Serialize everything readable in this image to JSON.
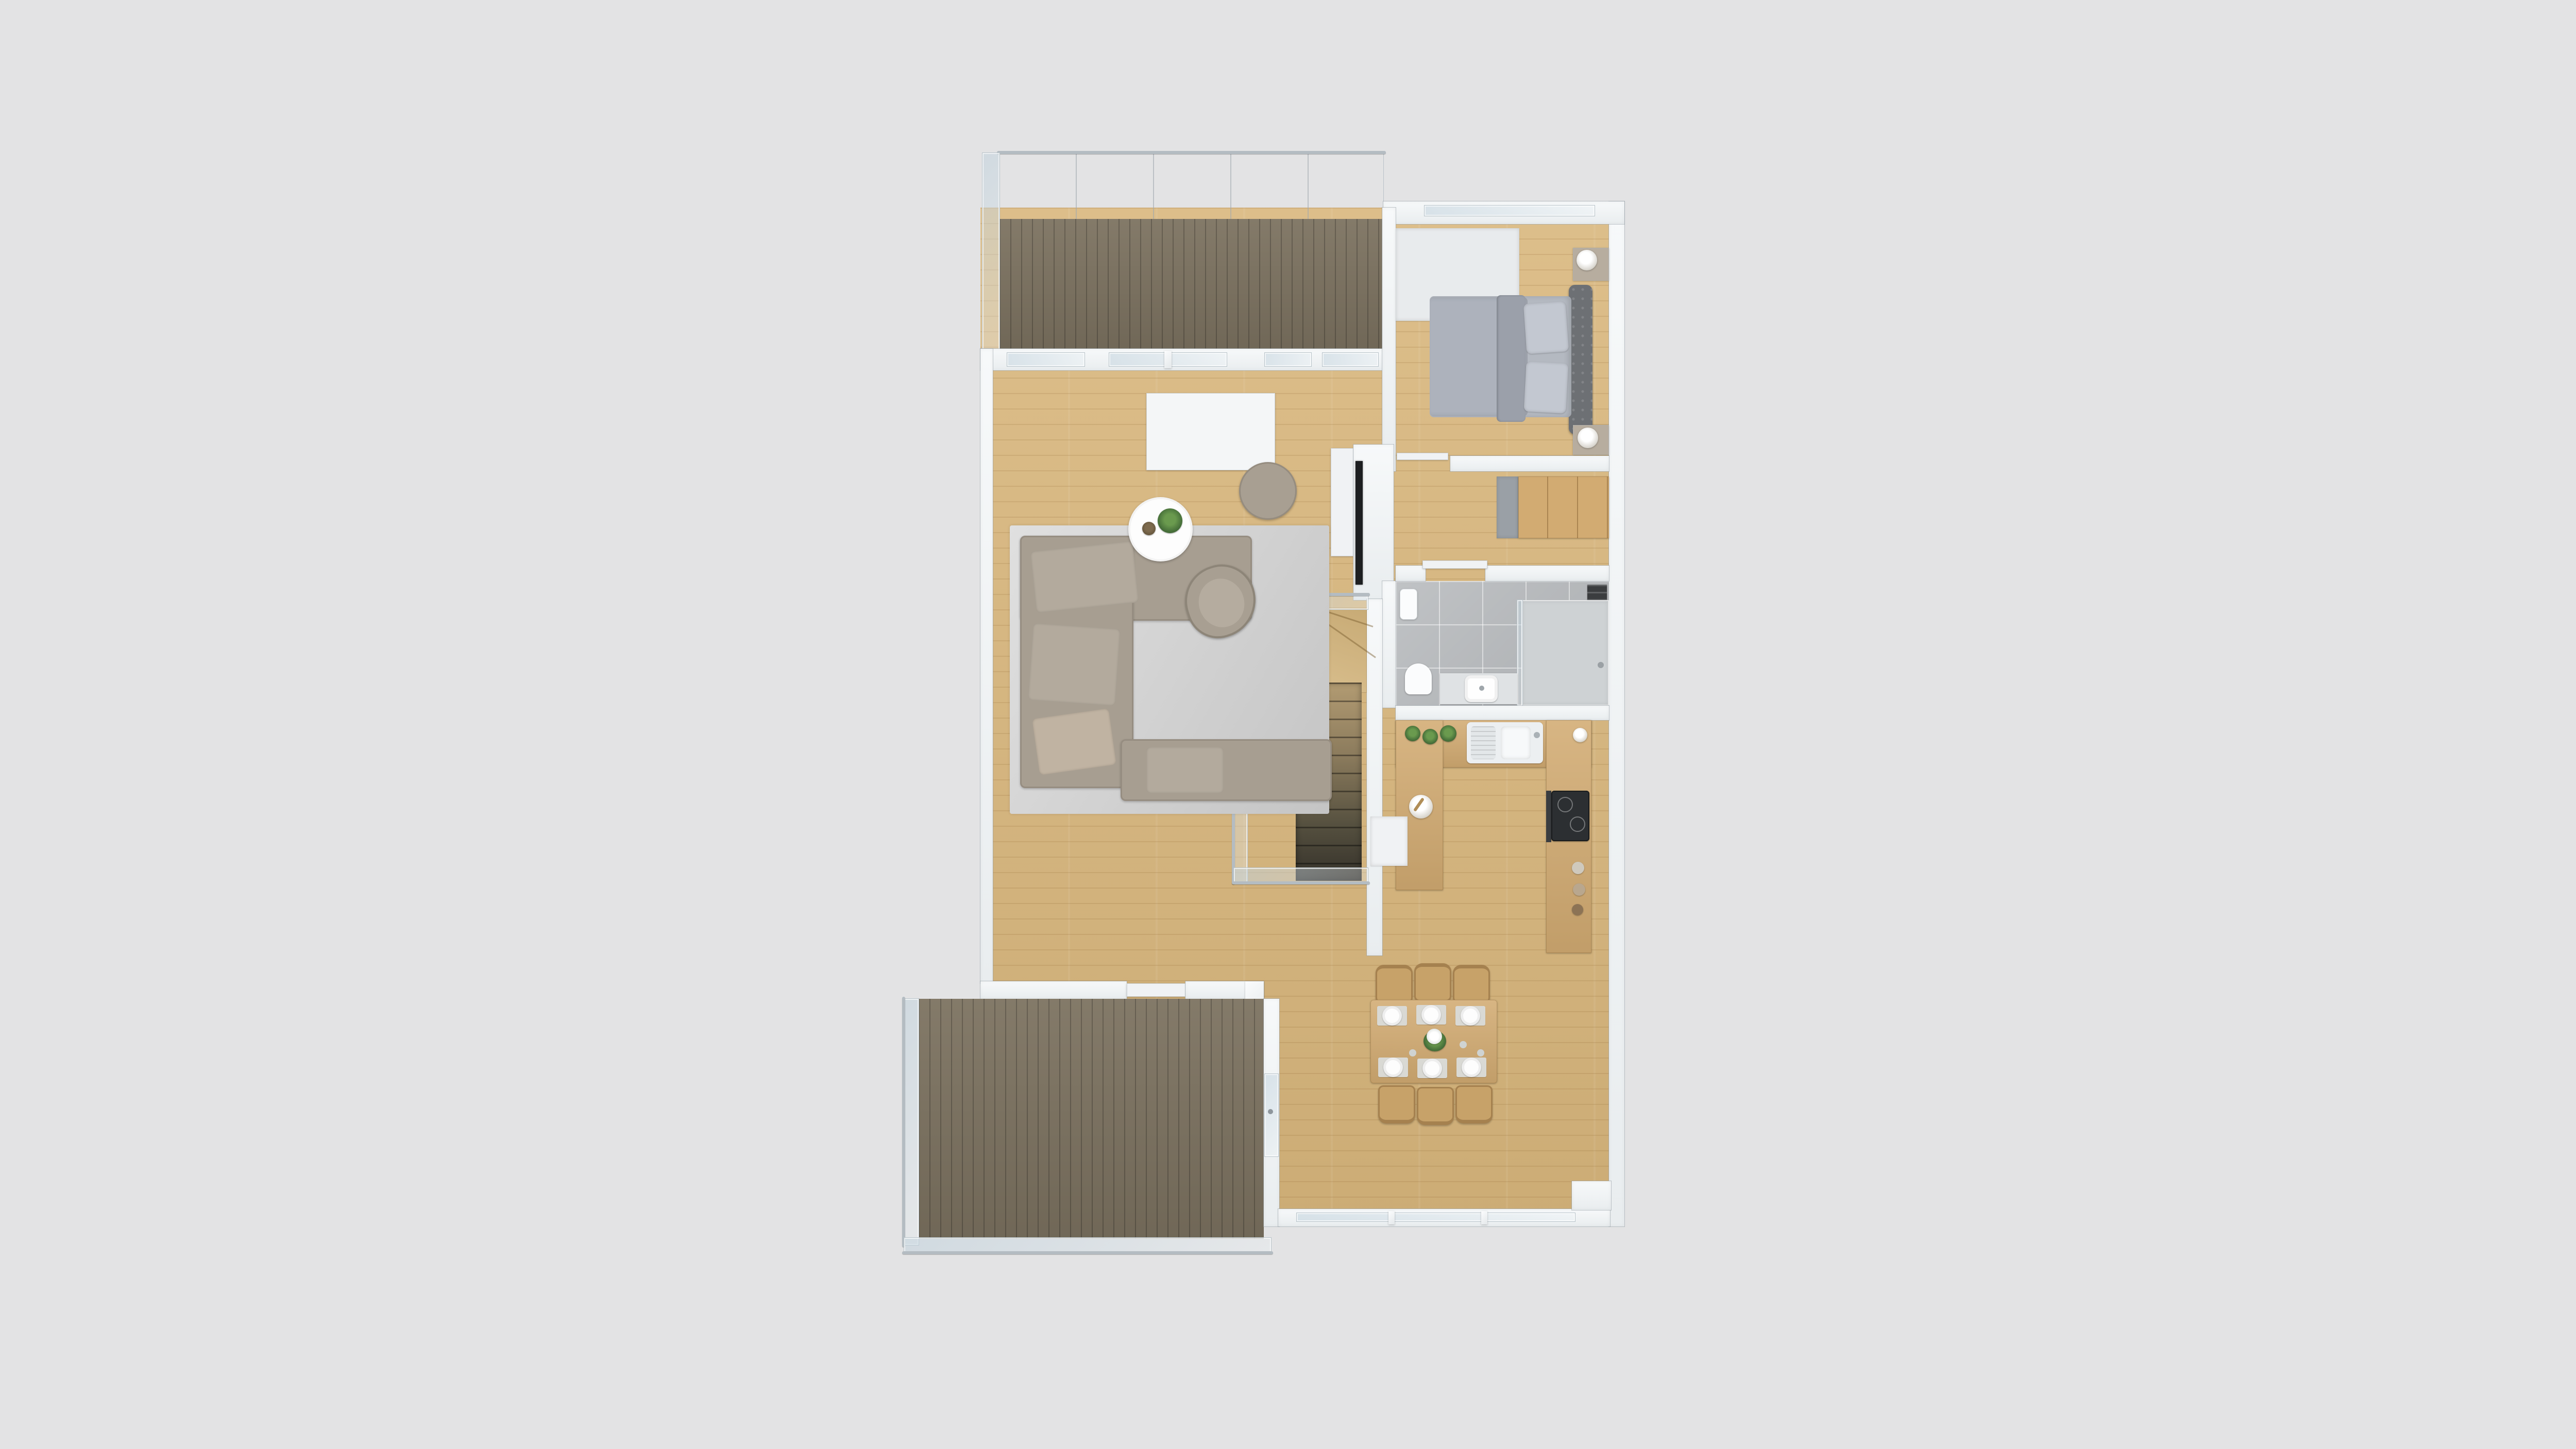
{
  "scene": {
    "type": "3d-floor-plan-render",
    "view": "top-down dollhouse",
    "background_color": "#e3e3e4",
    "floor_label": "First floor apartment plan"
  },
  "palette": {
    "background": "#e3e3e4",
    "wall_white": "#f2f4f6",
    "parquet_light_wood": "#d9b77d",
    "terrace_deck_wood": "#7d7361",
    "bathroom_tile_gray": "#b7babd",
    "sofa_taupe": "#a79e91",
    "bed_gray": "#adb2bc",
    "counter_wood": "#d2ab72",
    "cooktop_black": "#2c2f32",
    "rug_gray": "#cfcfcf",
    "glass_blue": "#c1d2dd",
    "plant_green": "#47703a"
  },
  "rooms": [
    {
      "id": "balcony-top",
      "label": "Balcony with privacy screen and wood decking"
    },
    {
      "id": "living-room",
      "label": "Living room"
    },
    {
      "id": "bedroom",
      "label": "Bedroom"
    },
    {
      "id": "hallway",
      "label": "Hallway with wardrobe"
    },
    {
      "id": "bathroom",
      "label": "Bathroom"
    },
    {
      "id": "kitchen",
      "label": "Kitchen"
    },
    {
      "id": "dining-area",
      "label": "Dining area"
    },
    {
      "id": "staircase",
      "label": "Winding staircase to lower floor"
    },
    {
      "id": "terrace-bottom",
      "label": "Terrace with glass railing"
    }
  ],
  "furniture": {
    "living_room": {
      "rug": "Gray area rug",
      "sofa": "L-shaped taupe sectional sofa with pillows",
      "coffee_table": "Round white coffee table with succulents",
      "pouf": "Round taupe pouf",
      "armchair": "Taupe swivel armchair",
      "tv": "Wall-mounted flat TV on partition",
      "sideboard": "Low white sideboard",
      "partition": "White partition screen at balcony doors"
    },
    "bedroom": {
      "bed": "Double bed with gray bedding and tufted headboard",
      "pillows": "Four gray pillows",
      "nightstand_north": "Nightstand with white lamp",
      "nightstand_south": "Nightstand with white lamp",
      "wardrobe": "Wood wardrobe unit",
      "blind_panel": "Light roller-blind wall panel"
    },
    "bathroom": {
      "toilet": "White toilet",
      "vanity": "Vanity with white vessel sink",
      "shower": "Walk-in shower with glass panel",
      "radiator": "Black towel radiator",
      "towel": "White hanging towel"
    },
    "kitchen": {
      "layout": "U-shaped kitchen counter with wood worktop",
      "sink": "Double-bowl sink with drainer",
      "cooktop": "Black induction cooktop",
      "herb_pots": "Three potted herbs",
      "mortar": "White bowl with pestle",
      "jars": "Storage jars on counter",
      "open_unit": "White open cabinet end unit"
    },
    "dining_area": {
      "table": "Rectangular wood dining table",
      "chairs": "Six wood dining chairs",
      "place_settings": "Six white plates on gray placemats",
      "centerpiece": "White flower bouquet"
    },
    "staircase": {
      "stairs": "Winding wood stairs descending",
      "railing": "Glass railing with chrome handrail"
    },
    "terraces": {
      "balcony_top": "Covered balcony, dark wood decking",
      "terrace_bottom": "Lower terrace, dark wood decking, glass balustrade",
      "sliding_door": "Sliding glass terrace door"
    }
  },
  "counts": {
    "dining_chairs": 6,
    "plates": 6,
    "bed_pillows": 4,
    "herb_pots": 3
  }
}
